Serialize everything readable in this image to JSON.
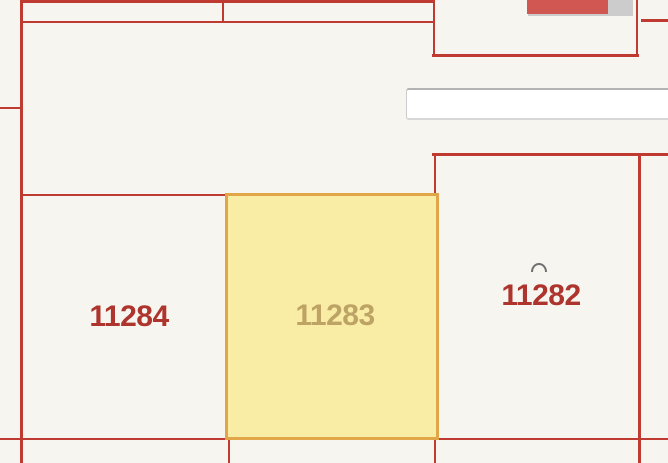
{
  "map": {
    "type": "cadastral-parcel-map",
    "background_color": "#f7f5ef",
    "parcel_line_color": "#bf3b31",
    "parcels": [
      {
        "id": "11284",
        "label": "11284",
        "label_color": "#ae342e",
        "highlighted": false
      },
      {
        "id": "11283",
        "label": "11283",
        "label_color": "#bda365",
        "highlighted": true,
        "fill_color": "#f9eda6",
        "border_color": "#e0a647"
      },
      {
        "id": "11282",
        "label": "11282",
        "label_color": "#ae342e",
        "highlighted": false
      }
    ],
    "road": {
      "fill_color": "#ffffff",
      "edge_color": "#b3b3b3"
    },
    "building": {
      "fill_color": "#d05752",
      "shadow_color": "#cccccc"
    },
    "curve_marker_color": "#6f6f6f"
  }
}
